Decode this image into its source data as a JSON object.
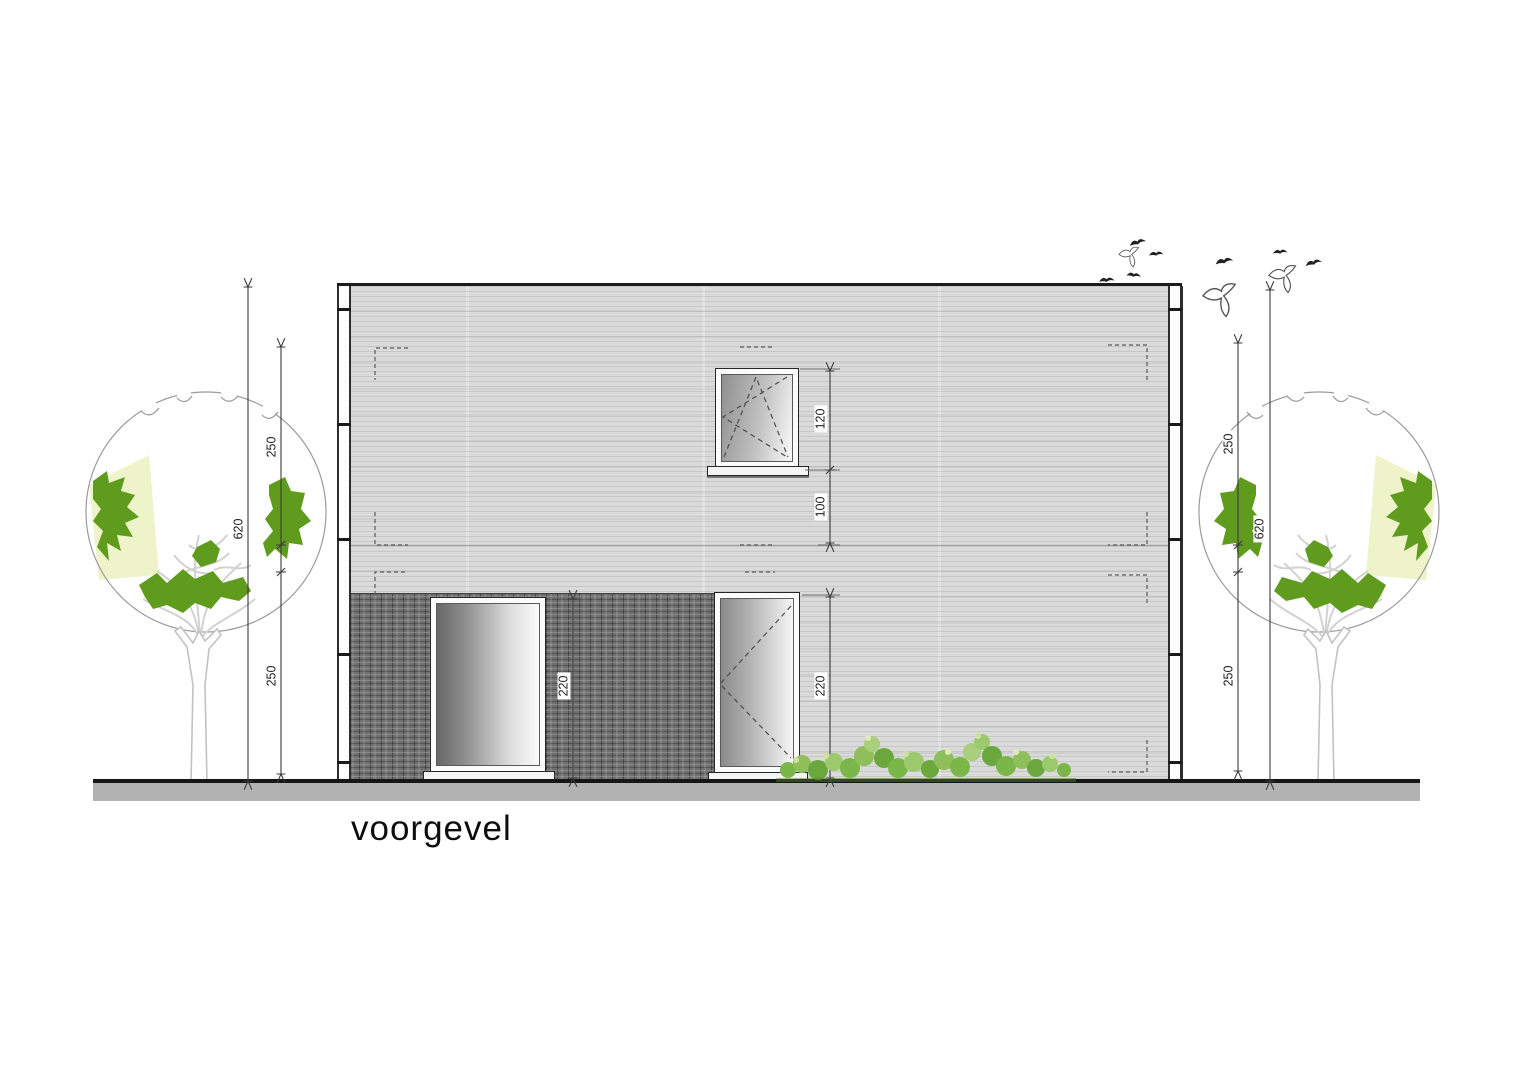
{
  "title": "voorgevel",
  "dims": {
    "left_total": "620",
    "left_upper": "250",
    "left_lower": "250",
    "right_total": "620",
    "right_upper": "250",
    "right_lower": "250",
    "window_height": "120",
    "window_sill_to_floor": "100",
    "door_left_height": "220",
    "door_right_height": "220"
  },
  "colors": {
    "facade": "#dadada",
    "brick": "#707070",
    "ground": "#b2b2b2",
    "dim": "#3a3a3a",
    "crown_outline": "#9a9a9a",
    "tree_green": "#5f9c1e",
    "branch": "#d2d2d2",
    "bush_green": "#7ab648",
    "bush_light": "#cfe3a0"
  }
}
